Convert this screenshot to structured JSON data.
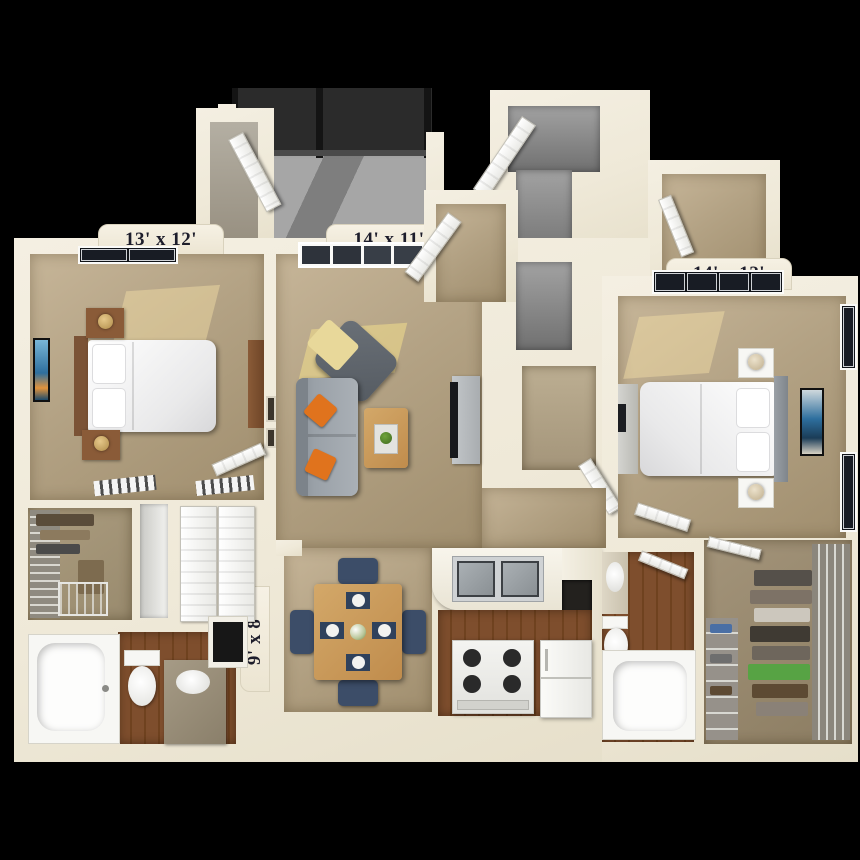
{
  "floorplan": {
    "type": "3d-apartment-floor-plan",
    "rooms": {
      "bedroom_left": {
        "label": "13' x 12'"
      },
      "living_room": {
        "label": "14' x 11'"
      },
      "bedroom_right": {
        "label": "14' x 12'"
      },
      "dining_room": {
        "label": "9' x 8'"
      }
    },
    "colors": {
      "background": "#000000",
      "wall": "#efe9d8",
      "carpet": "#b3a284",
      "wood_floor": "#7a4a2a",
      "entry_tile": "#8f8f8f",
      "balcony_concrete": "#a6a6a6",
      "balcony_railing": "#2b2b2b",
      "sofa_gray": "#9aa1a8",
      "pillow_orange": "#e0731d",
      "throw_yellow": "#e8d89a",
      "chair_navy": "#3c4d68",
      "table_wood": "#c99a5e",
      "plant_green": "#4a7a28",
      "art_blue": "#2e6f9e",
      "nightstand_brown": "#8a5b38",
      "label_text": "#1d1d2b"
    }
  }
}
